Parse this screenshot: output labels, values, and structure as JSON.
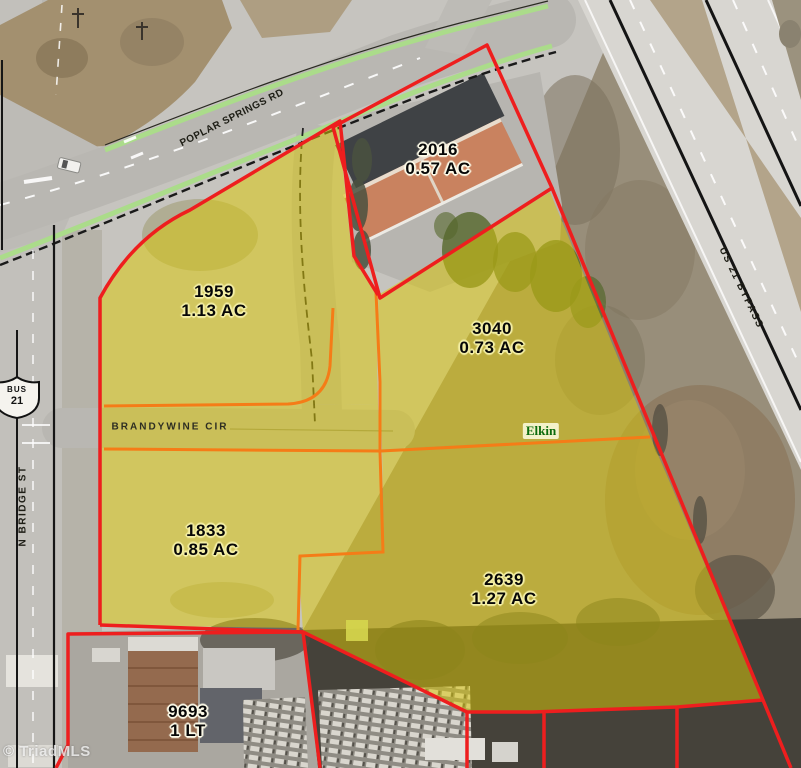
{
  "map": {
    "watermark": "© TriadMLS",
    "city_label": "Elkin",
    "roads": {
      "poplar": "POPLAR SPRINGS RD",
      "brandywine": "BRANDYWINE CIR",
      "n_bridge": "N BRIDGE ST",
      "us21_bypass": "US 21 BYPASS",
      "route_shield": {
        "line1": "BUS",
        "line2": "21"
      }
    },
    "parcels": [
      {
        "id": "2016",
        "area": "0.57 AC"
      },
      {
        "id": "1959",
        "area": "1.13 AC"
      },
      {
        "id": "3040",
        "area": "0.73 AC"
      },
      {
        "id": "1833",
        "area": "0.85 AC"
      },
      {
        "id": "2639",
        "area": "1.27 AC"
      },
      {
        "id": "9693",
        "area": "1 LT"
      }
    ],
    "colors": {
      "parcel_outline": "#ee1e1e",
      "lot_line": "#f57c17",
      "highlight": "#dbc90a",
      "road_stripe": "#abdc8a",
      "city_text": "#0c6b0c"
    }
  }
}
